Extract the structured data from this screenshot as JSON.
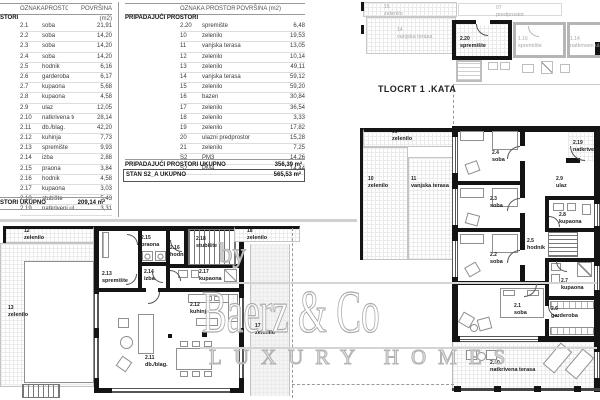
{
  "plan_title": "TLOCRT 1 .KATA",
  "watermark": {
    "by": "by",
    "name": "Baerz & Co",
    "tagline": "LUXURY HOMES"
  },
  "tables": {
    "left": {
      "headers": [
        "OZNAKA",
        "PROSTOR",
        "POVRŠINA (m2)"
      ],
      "section": "STORI",
      "rows": [
        [
          "2.1",
          "soba",
          "21,91"
        ],
        [
          "2.2",
          "soba",
          "14,20"
        ],
        [
          "2.3",
          "soba",
          "14,20"
        ],
        [
          "2.4",
          "soba",
          "14,20"
        ],
        [
          "2.5",
          "hodnik",
          "6,16"
        ],
        [
          "2.6",
          "garderoba",
          "6,17"
        ],
        [
          "2.7",
          "kupaona",
          "5,68"
        ],
        [
          "2.8",
          "kupaona",
          "4,58"
        ],
        [
          "2.9",
          "ulaz",
          "12,05"
        ],
        [
          "2.10",
          "natkrivena terasa",
          "28,14"
        ],
        [
          "2.11",
          "db./blag.",
          "42,20"
        ],
        [
          "2.12",
          "kuhinja",
          "7,73"
        ],
        [
          "2.13",
          "spremište",
          "9,93"
        ],
        [
          "2.14",
          "izba",
          "2,88"
        ],
        [
          "2.15",
          "praona",
          "3,84"
        ],
        [
          "2.16",
          "hodnik",
          "4,58"
        ],
        [
          "2.17",
          "kupaona",
          "3,03"
        ],
        [
          "2.18",
          "stubište",
          "5,43"
        ],
        [
          "2.19",
          "natkriveni ulaz",
          "3,31"
        ]
      ],
      "footer": {
        "label": "STORI UKUPNO",
        "value": "209,14 m²"
      }
    },
    "right": {
      "headers": [
        "OZNAKA",
        "PROSTOR",
        "POVRŠINA (m2)"
      ],
      "section": "PRIPADAJUĆI PROSTORI",
      "rows": [
        [
          "2.20",
          "spremište",
          "6,48"
        ],
        [
          "10",
          "zelenilo",
          "19,53"
        ],
        [
          "11",
          "vanjska terasa",
          "13,05"
        ],
        [
          "12",
          "zelenilo",
          "10,14"
        ],
        [
          "13",
          "zelenilo",
          "49,11"
        ],
        [
          "14",
          "vanjska terasa",
          "59,12"
        ],
        [
          "15",
          "zelenilo",
          "59,20"
        ],
        [
          "16",
          "bazen",
          "30,84"
        ],
        [
          "17",
          "zelenilo",
          "36,54"
        ],
        [
          "18",
          "zelenilo",
          "3,33"
        ],
        [
          "19",
          "zelenilo",
          "17,82"
        ],
        [
          "20",
          "ulazni predprostor",
          "15,28"
        ],
        [
          "21",
          "zelenilo",
          "7,25"
        ],
        [
          "S2",
          "PM3",
          "14,26"
        ],
        [
          "S2",
          "PM4",
          "14,44"
        ]
      ],
      "footer": {
        "label": "PRIPADAJUĆI PROSTORI UKUPNO",
        "value": "356,39 m²"
      },
      "total": {
        "label": "STAN S2_A UKUPNO",
        "value": "565,53 m²"
      }
    }
  },
  "plans": [
    {
      "id": "upper-plan",
      "labels": [
        {
          "c": "15",
          "n": "zelenilo",
          "x": 384,
          "y": 4,
          "g": 1
        },
        {
          "c": "14",
          "n": "vanjska terasa",
          "x": 397,
          "y": 27,
          "g": 1
        },
        {
          "c": "07",
          "n": "predprostor",
          "x": 496,
          "y": 5,
          "g": 1
        },
        {
          "c": "2.20",
          "n": "spremište",
          "x": 460,
          "y": 36
        },
        {
          "c": "1.16",
          "n": "spremište",
          "x": 518,
          "y": 36,
          "g": 1
        },
        {
          "c": "1.14",
          "n": "natkriveni ulaz",
          "x": 570,
          "y": 36,
          "g": 1
        }
      ]
    },
    {
      "id": "main-plan",
      "labels": [
        {
          "c": "09",
          "n": "zelenilo",
          "x": 392,
          "y": 129
        },
        {
          "c": "10",
          "n": "zelenilo",
          "x": 368,
          "y": 176
        },
        {
          "c": "11",
          "n": "vanjska terasa",
          "x": 411,
          "y": 176
        },
        {
          "c": "2.4",
          "n": "soba",
          "x": 492,
          "y": 150
        },
        {
          "c": "2.3",
          "n": "soba",
          "x": 490,
          "y": 196
        },
        {
          "c": "2.2",
          "n": "soba",
          "x": 490,
          "y": 252
        },
        {
          "c": "2.1",
          "n": "soba",
          "x": 514,
          "y": 303
        },
        {
          "c": "2.9",
          "n": "ulaz",
          "x": 556,
          "y": 176
        },
        {
          "c": "2.8",
          "n": "kupaona",
          "x": 559,
          "y": 212
        },
        {
          "c": "2.5",
          "n": "hodnik",
          "x": 527,
          "y": 238
        },
        {
          "c": "2.19",
          "n": "natkriveni ulaz",
          "x": 573,
          "y": 140
        },
        {
          "c": "2.7",
          "n": "kupaona",
          "x": 561,
          "y": 278
        },
        {
          "c": "2.6",
          "n": "garderoba",
          "x": 551,
          "y": 306
        },
        {
          "c": "2.10",
          "n": "natkrivena terasa",
          "x": 490,
          "y": 360
        }
      ]
    },
    {
      "id": "left-plan",
      "labels": [
        {
          "c": "12",
          "n": "zelenilo",
          "x": 24,
          "y": 228
        },
        {
          "c": "13",
          "n": "zelenilo",
          "x": 8,
          "y": 305
        },
        {
          "c": "2.15",
          "n": "praona",
          "x": 141,
          "y": 235
        },
        {
          "c": "2.16",
          "n": "hodnik",
          "x": 170,
          "y": 245
        },
        {
          "c": "2.13",
          "n": "spremište",
          "x": 102,
          "y": 271
        },
        {
          "c": "2.14",
          "n": "izba",
          "x": 144,
          "y": 269
        },
        {
          "c": "2.18",
          "n": "stubište",
          "x": 196,
          "y": 236
        },
        {
          "c": "2.17",
          "n": "kupaona",
          "x": 199,
          "y": 269
        },
        {
          "c": "2.12",
          "n": "kuhinja",
          "x": 190,
          "y": 302
        },
        {
          "c": "2.11",
          "n": "db./blag.",
          "x": 145,
          "y": 355
        },
        {
          "c": "18",
          "n": "zelenilo",
          "x": 247,
          "y": 228
        },
        {
          "c": "17",
          "n": "zelenilo",
          "x": 255,
          "y": 323
        }
      ]
    }
  ]
}
